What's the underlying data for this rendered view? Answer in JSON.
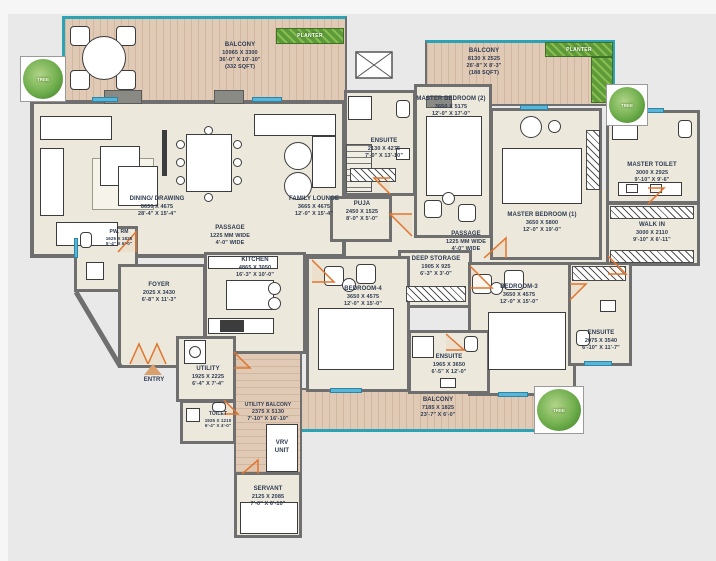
{
  "title": "Apartment Floor Plan",
  "colors": {
    "background": "#e9e9e9",
    "wall": "#6f6f6f",
    "floor": "#ece8db",
    "balcony_wood": "#e0cab5",
    "balcony_edge_teal": "#2ba3b4",
    "door_orange": "#e0762e",
    "planter_green": "#5c9a3a",
    "window_blue": "#58b6d8",
    "text": "#2e3b52"
  },
  "rooms": {
    "balcony_tl": {
      "name": "BALCONY",
      "mm": "10965 X 3300",
      "ft": "36'-0\" X 10'-10\"",
      "sqft": "(332 SQFT)"
    },
    "balcony_tr": {
      "name": "BALCONY",
      "mm": "8130 X 2525",
      "ft": "26'-8\" X 8'-3\"",
      "sqft": "(188 SQFT)"
    },
    "balcony_bottom": {
      "name": "BALCONY",
      "mm": "7185 X 1825",
      "ft": "23'-7\" X 6'-0\""
    },
    "utility_balcony": {
      "name": "UTILITY BALCONY",
      "mm": "2375 X 5130",
      "ft": "7'-10\" X 16'-10\""
    },
    "dining": {
      "name": "DINING/ DRAWING",
      "mm": "8630 X 4675",
      "ft": "28'-4\" X 15'-4\""
    },
    "family_lounge": {
      "name": "FAMILY LOUNGE",
      "mm": "3665 X 4675",
      "ft": "12'-0\" X 15'-4\""
    },
    "kitchen": {
      "name": "KITCHEN",
      "mm": "4865 X 3050",
      "ft": "16'-3\" X 10'-0\""
    },
    "foyer": {
      "name": "FOYER",
      "mm": "2025 X 3430",
      "ft": "6'-8\" X 11'-3\""
    },
    "pw_rm": {
      "name": "PW. RM",
      "mm": "1625 X 1825",
      "ft": "5'-4\" X 6'-0\""
    },
    "passage": {
      "name": "PASSAGE",
      "mm": "1225 MM WIDE",
      "ft": "4'-0\" WIDE"
    },
    "puja": {
      "name": "PUJA",
      "mm": "2450 X 1525",
      "ft": "8'-0\" X 5'-0\""
    },
    "ensuite_m2": {
      "name": "ENSUITE",
      "mm": "2130 X 4275",
      "ft": "7'-0\" X 13'-10\""
    },
    "master_bedroom_2": {
      "name": "MASTER BEDROOM (2)",
      "mm": "3650 X 5175",
      "ft": "12'-0\" X 17'-0\""
    },
    "master_bedroom_1": {
      "name": "MASTER BEDROOM (1)",
      "mm": "3650 X 5800",
      "ft": "12'-0\" X 19'-0\""
    },
    "master_toilet": {
      "name": "MASTER TOILET",
      "mm": "3000 X 2925",
      "ft": "9'-10\" X 9'-6\""
    },
    "walk_in": {
      "name": "WALK IN",
      "mm": "3000 X 2110",
      "ft": "9'-10\" X 6'-11\""
    },
    "deep_storage": {
      "name": "DEEP STORAGE",
      "mm": "1905 X 925",
      "ft": "6'-3\" X 3'-0\""
    },
    "bedroom_4": {
      "name": "BEDROOM-4",
      "mm": "3650 X 4575",
      "ft": "12'-0\" X 15'-0\""
    },
    "bedroom_3": {
      "name": "BEDROOM-3",
      "mm": "3650 X 4575",
      "ft": "12'-0\" X 15'-0\""
    },
    "ensuite_b4": {
      "name": "ENSUITE",
      "mm": "1965 X 3650",
      "ft": "6'-5\" X 12'-0\""
    },
    "ensuite_b3": {
      "name": "ENSUITE",
      "mm": "2075 X 3540",
      "ft": "6'-10\" X 11'-7\""
    },
    "utility": {
      "name": "UTILITY",
      "mm": "1925 X 2225",
      "ft": "6'-4\" X 7'-4\""
    },
    "toilet": {
      "name": "TOILET",
      "mm": "1925 X 1210",
      "ft": "6'-4\" X 4'-0\""
    },
    "servant": {
      "name": "SERVANT",
      "mm": "2125 X 2085",
      "ft": "7'-0\" X 6'-10\""
    }
  },
  "labels": {
    "entry": "ENTRY",
    "vrv_line1": "VRV",
    "vrv_line2": "UNIT",
    "tree": "TREE",
    "planter": "PLANTER"
  }
}
